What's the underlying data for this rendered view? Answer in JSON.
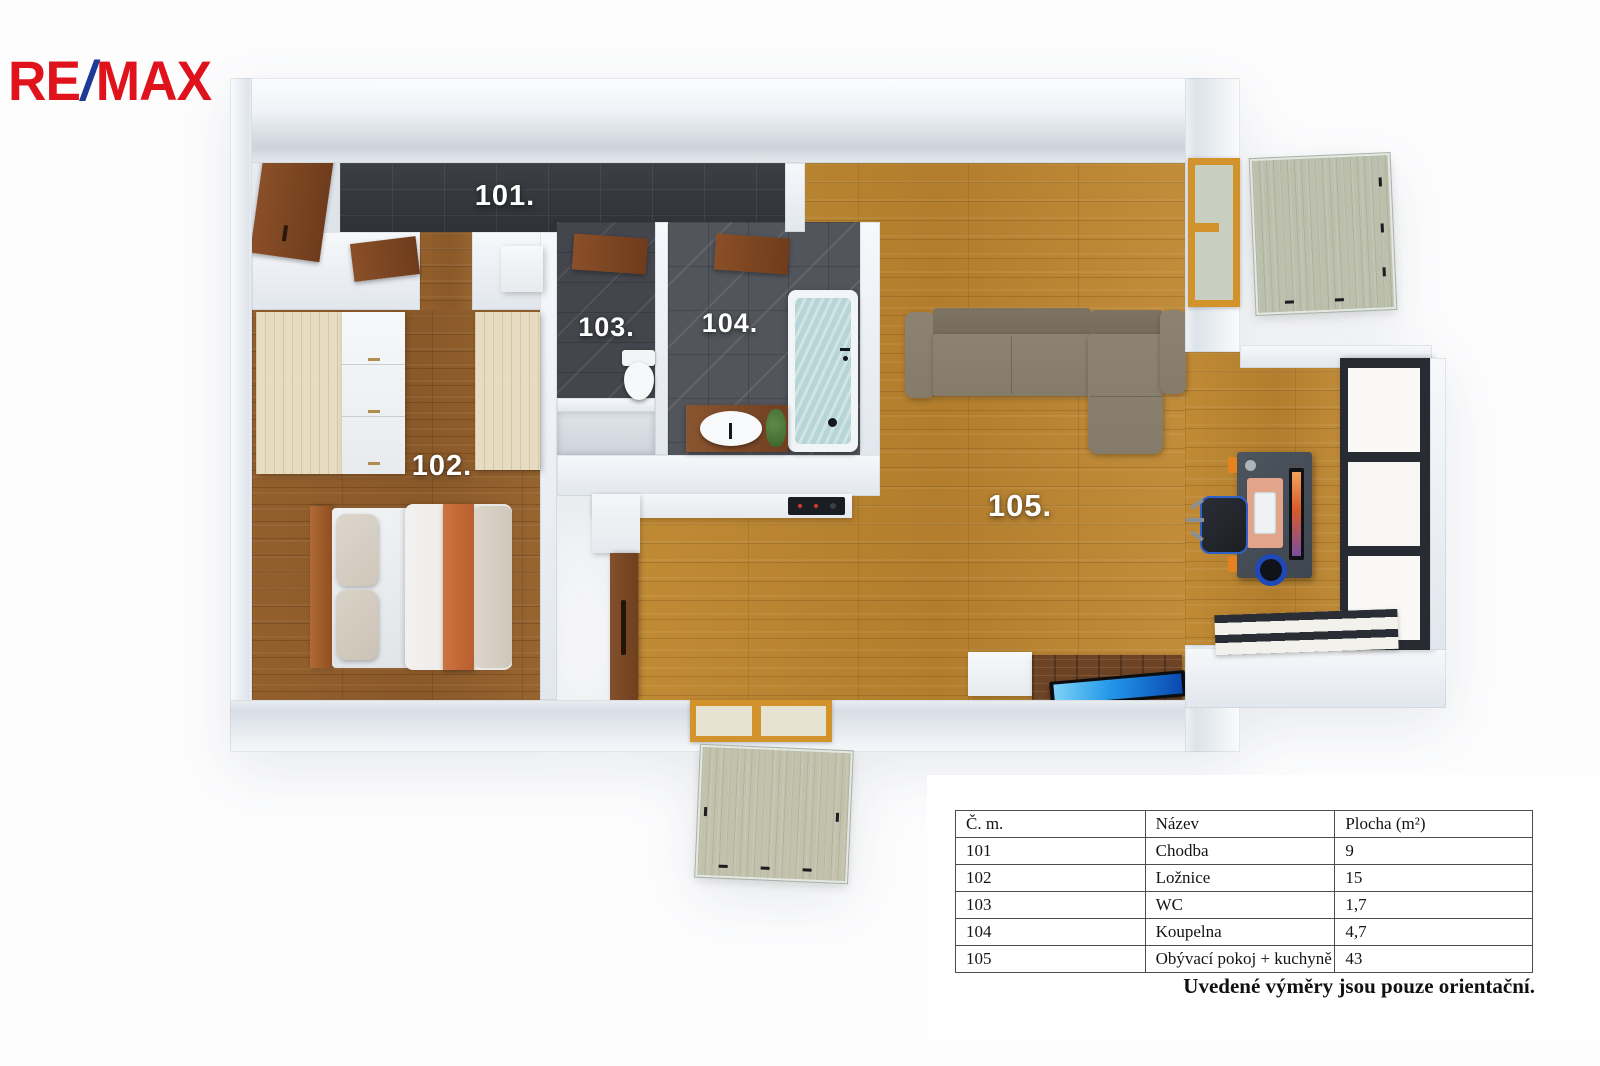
{
  "logo": {
    "re": "RE",
    "slash": "/",
    "max": "MAX"
  },
  "rooms": {
    "hallway": {
      "label": "101."
    },
    "bedroom": {
      "label": "102."
    },
    "wc": {
      "label": "103."
    },
    "bathroom": {
      "label": "104."
    },
    "living": {
      "label": "105."
    }
  },
  "legend": {
    "columns": [
      "Č. m.",
      "Název",
      "Plocha (m²)"
    ],
    "rows": [
      {
        "num": "101",
        "name": "Chodba",
        "area": "9"
      },
      {
        "num": "102",
        "name": "Ložnice",
        "area": "15"
      },
      {
        "num": "103",
        "name": "WC",
        "area": "1,7"
      },
      {
        "num": "104",
        "name": "Koupelna",
        "area": "4,7"
      },
      {
        "num": "105",
        "name": "Obývací pokoj + kuchyně",
        "area": "43"
      }
    ],
    "note": "Uvedené výměry jsou pouze orientační."
  },
  "colors": {
    "remax_red": "#e0131d",
    "remax_blue": "#1d3a96",
    "hall_floor": "#36393f",
    "living_floor": "#bb8634",
    "bedroom_floor": "#8f5e2c",
    "label_text": "#ffffff"
  }
}
